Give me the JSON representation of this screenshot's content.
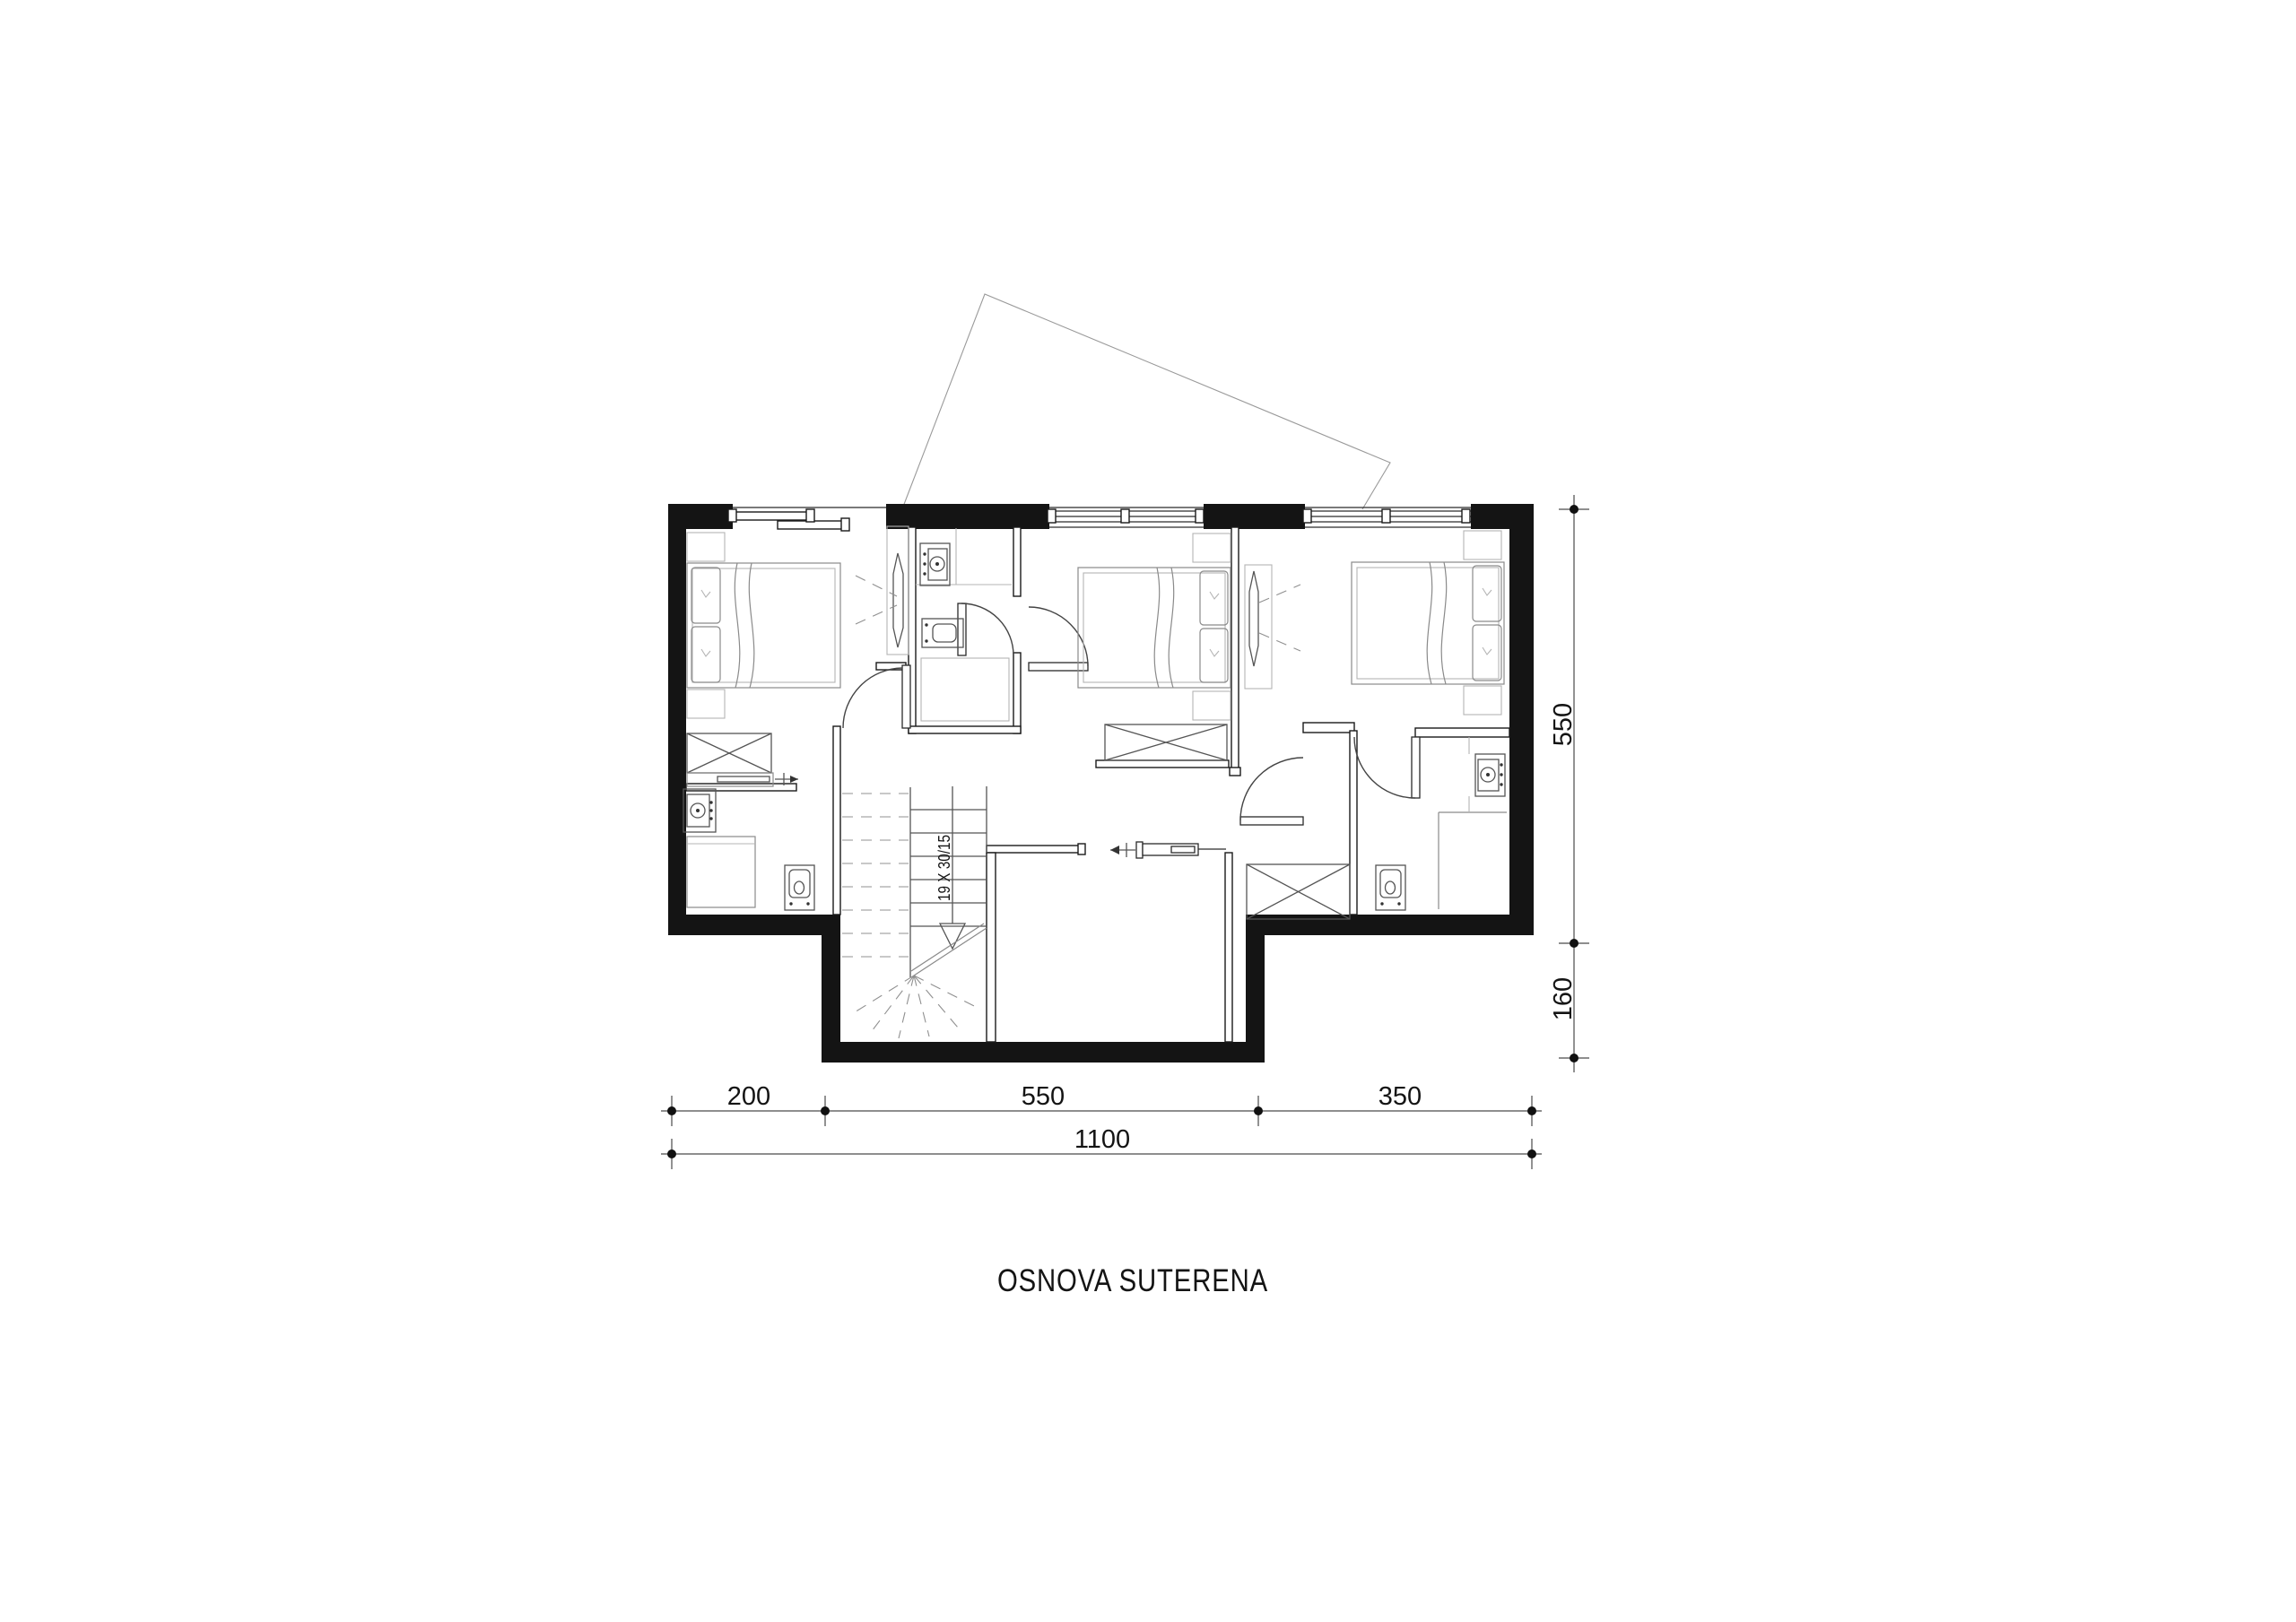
{
  "title": "OSNOVA  SUTERENA",
  "stair": {
    "label": "19 X 30/15"
  },
  "dims": {
    "seg200": "200",
    "seg550": "550",
    "seg350": "350",
    "total": "1100",
    "right550": "550",
    "right160": "160"
  },
  "colors": {
    "wall": "#141414",
    "furniture_gray": "#8a8a8a",
    "dimension_gray": "#4a4a4a",
    "background": "#ffffff"
  }
}
